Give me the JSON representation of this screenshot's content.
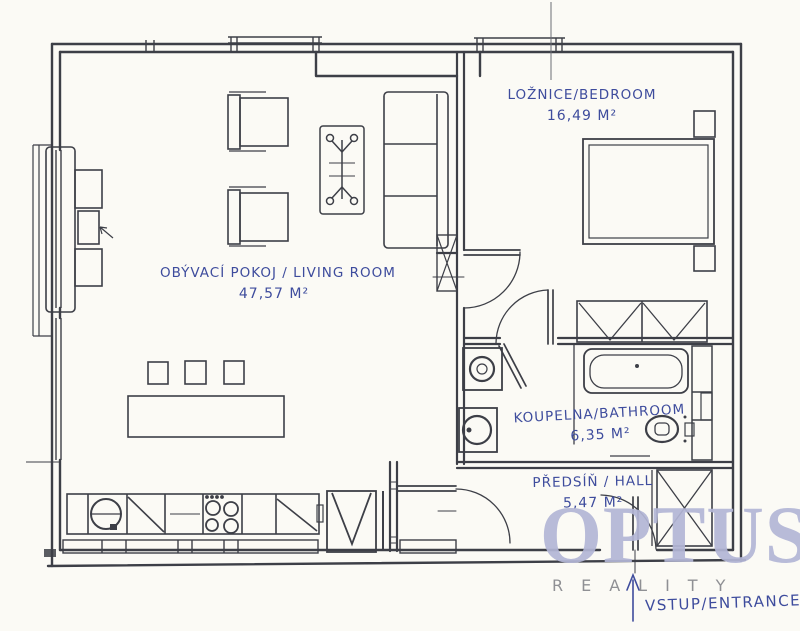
{
  "plan": {
    "type": "apartment-floor-plan",
    "rooms": [
      {
        "id": "living-room",
        "label": "OBÝVACÍ POKOJ / LIVING ROOM",
        "area": "47,57 M²"
      },
      {
        "id": "bedroom",
        "label": "LOŽNICE/BEDROOM",
        "area": "16,49 M²"
      },
      {
        "id": "bathroom",
        "label": "KOUPELNA/BATHROOM",
        "area": "6,35 M²"
      },
      {
        "id": "hall",
        "label": "PŘEDSÍŇ / HALL",
        "area": "5,47 M²"
      }
    ],
    "entrance_label": "VSTUP/ENTRANCE",
    "watermark": {
      "brand": "OPTUS",
      "subtitle": "REALITY"
    },
    "furniture_icons": [
      "sofa",
      "armchair",
      "armchair",
      "coffee-table",
      "tv-cabinet",
      "dining-table",
      "stool",
      "stool",
      "stool",
      "kitchen-counter",
      "kitchen-sink",
      "stove",
      "refrigerator",
      "double-bed",
      "nightstand",
      "nightstand",
      "wardrobe",
      "washing-machine",
      "bathtub",
      "washbasin",
      "toilet",
      "hall-wardrobe",
      "door",
      "window",
      "entrance-arrow"
    ],
    "colors": {
      "ink": "#3d3f47",
      "annotation": "#3e4c9d",
      "watermark_brand": "#b3b6d6",
      "watermark_subtitle": "#8f9094",
      "paper": "#fbfaf5"
    }
  }
}
